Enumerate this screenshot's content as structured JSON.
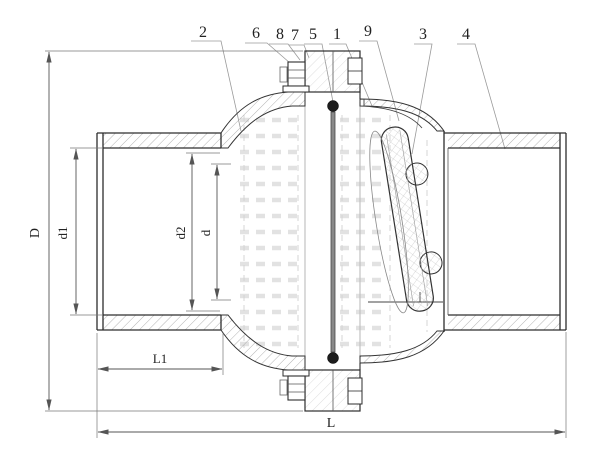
{
  "callouts": [
    "2",
    "6",
    "8",
    "7",
    "5",
    "1",
    "9",
    "3",
    "4"
  ],
  "dim_labels": {
    "D": "D",
    "d1": "d1",
    "d2": "d2",
    "d": "d",
    "L1": "L1",
    "L": "L"
  },
  "colors": {
    "outline": "#2d2d2d",
    "dimension_line": "#555555",
    "hatch": "#a0a0a0",
    "hidden_detail": "#d8d8d8",
    "pin_fill": "#1c1c1c",
    "background": "#ffffff"
  }
}
